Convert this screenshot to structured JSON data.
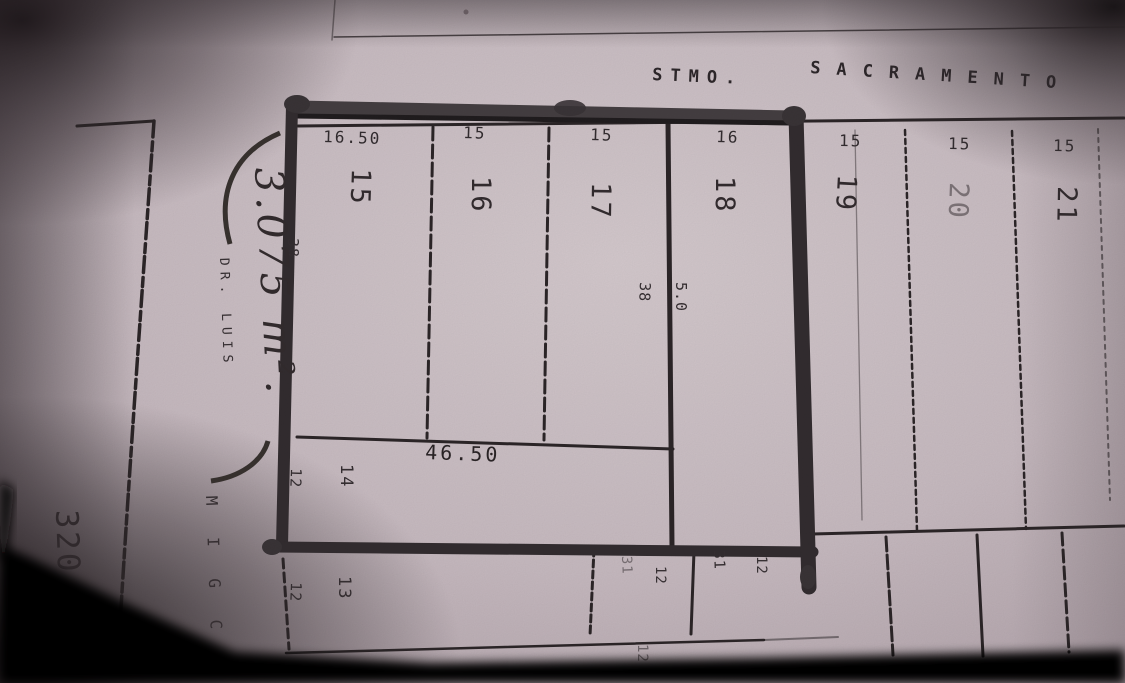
{
  "street": {
    "prefix": "STMO.",
    "name": "SACRAMENTO"
  },
  "block": {
    "lot_widths": [
      "16.50",
      "15",
      "15",
      "16",
      "15",
      "15",
      "15"
    ],
    "lot_numbers": [
      "15",
      "16",
      "17",
      "18",
      "19",
      "20",
      "21"
    ],
    "west_side_depth": "38",
    "divider_depth_left": "38",
    "divider_depth_right": "5.0",
    "south_width": "46.50",
    "strip_lots": [
      {
        "number": "14",
        "depth": "12"
      },
      {
        "number": "13",
        "depth": "12"
      }
    ],
    "south_lots": [
      {
        "number": "31",
        "depth": "12"
      },
      {
        "number": "31",
        "depth": "12"
      }
    ],
    "cut_label": "12"
  },
  "annotations": {
    "area": "3.075 m².",
    "street_west_line1": "DR. LUIS",
    "street_west_line2": "M I G C",
    "facing_block_number": "320"
  }
}
